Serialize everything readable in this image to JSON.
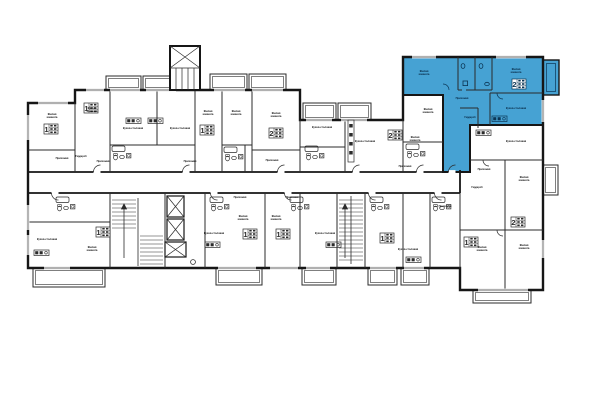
{
  "document": {
    "type": "architectural-floor-plan",
    "language": "ru",
    "background": "#FFFFFF"
  },
  "labels": {
    "living_room": "Жилая комната",
    "living_room_lines": [
      "Жилая",
      "комната"
    ],
    "kitchen_dining": "Кухня-столовая",
    "hallway": "Прихожая",
    "wardrobe": "Гардероб"
  },
  "apartment_numbers": [
    "1",
    "1",
    "1",
    "2",
    "2",
    "2",
    "1",
    "1",
    "1",
    "1",
    "1",
    "2"
  ],
  "highlighted_unit": {
    "highlight_color": "#46A2D3",
    "position_hint": "top-right",
    "rooms": [
      "Жилая комната",
      "Жилая комната",
      "Прихожая",
      "Гардероб",
      "Кухня-столовая"
    ]
  },
  "colors": {
    "background": "#FFFFFF",
    "walls": "#161616",
    "thin_lines": "#2B2B2B",
    "highlight": "#46A2D3",
    "highlight_lines": "#0B3554",
    "label_text": "#101010",
    "label_text_on_highlight": "#04233E"
  }
}
